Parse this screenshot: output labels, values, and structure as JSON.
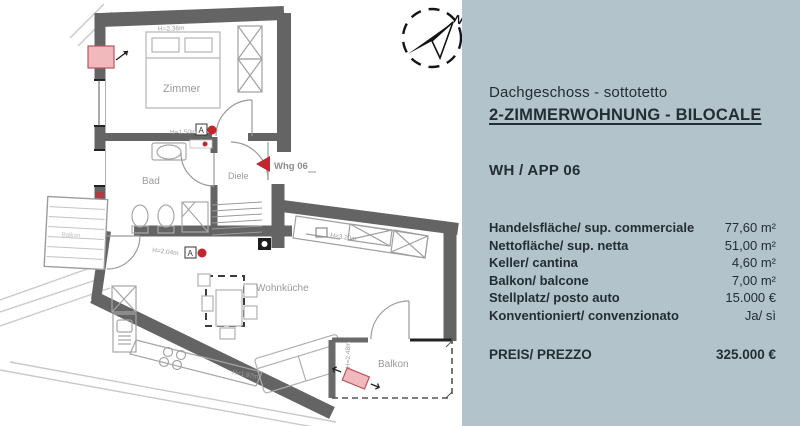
{
  "panel": {
    "bg": "#b2c3cc",
    "floor_line": "Dachgeschoss - sottotetto",
    "title": "2-ZIMMERWOHNUNG - BILOCALE",
    "unit": "WH / APP 06",
    "rows": [
      {
        "label": "Handelsfläche/ sup. commerciale",
        "value": "77,60 m²"
      },
      {
        "label": "Nettofläche/ sup. netta",
        "value": "51,00 m²"
      },
      {
        "label": "Keller/ cantina",
        "value": "4,60 m²"
      },
      {
        "label": "Balkon/ balcone",
        "value": "7,00 m²"
      },
      {
        "label": "Stellplatz/ posto auto",
        "value": "15.000 €"
      },
      {
        "label": "Konventioniert/ convenzionato",
        "value": "Ja/ sì"
      }
    ],
    "price_label": "PREIS/ PREZZO",
    "price_value": "325.000 €"
  },
  "floorplan": {
    "rooms": {
      "zimmer": "Zimmer",
      "bad": "Bad",
      "diele": "Diele",
      "wohnkueche": "Wohnküche",
      "balkon": "Balkon",
      "neighbor_balkon": "Balkon"
    },
    "entrance_label": "Whg 06",
    "dims": {
      "zimmer_top": "H=2.36m",
      "zimmer_door": "H=1.50m",
      "wohnkueche_top": "H=2.04m",
      "tv_wall": "H=3.20m",
      "kitchen": "H=1.97m",
      "balcony_door": "H=2.48m"
    },
    "compass_label": "N",
    "accent_red": "#c1272d"
  }
}
